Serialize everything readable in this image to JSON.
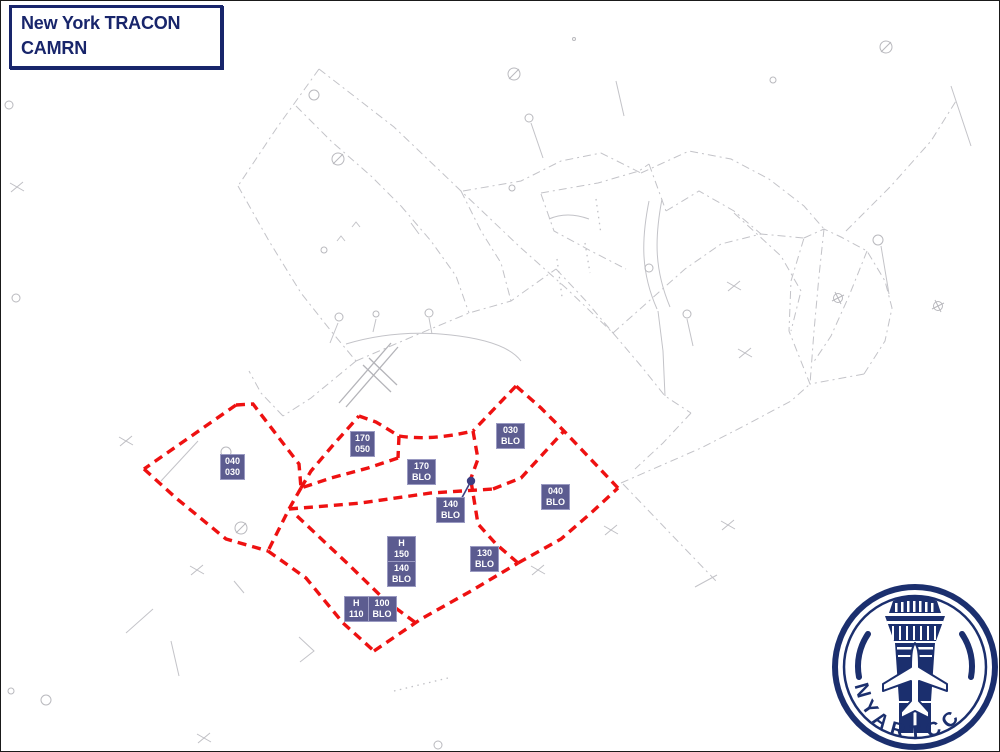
{
  "header": {
    "line1": "New York TRACON",
    "line2": "CAMRN"
  },
  "colors": {
    "navy": "#18256b",
    "red_boundary": "#ee1111",
    "label_background": "#5c5c90",
    "label_text": "#ffffff",
    "background_lines": "#c3c3c8"
  },
  "altitude_labels": [
    {
      "name": "sector-040-030",
      "lines": [
        "040",
        "030"
      ]
    },
    {
      "name": "sector-170-050",
      "lines": [
        "170",
        "050"
      ]
    },
    {
      "name": "sector-170-blo",
      "lines": [
        "170",
        "BLO"
      ]
    },
    {
      "name": "sector-030-blo",
      "lines": [
        "030",
        "BLO"
      ]
    },
    {
      "name": "sector-040-blo",
      "lines": [
        "040",
        "BLO"
      ]
    },
    {
      "name": "sector-140-blo",
      "lines": [
        "140",
        "BLO"
      ]
    },
    {
      "name": "sector-130-blo",
      "lines": [
        "130",
        "BLO"
      ]
    },
    {
      "name": "sector-h-150-140-blo",
      "cells": [
        [
          "H",
          "150"
        ],
        [
          "140",
          "BLO"
        ]
      ]
    },
    {
      "name": "sector-h-110-100-blo",
      "cells": [
        [
          "H",
          "110"
        ],
        [
          "100",
          "BLO"
        ]
      ]
    }
  ],
  "logo": {
    "text": "NYARTCC"
  }
}
